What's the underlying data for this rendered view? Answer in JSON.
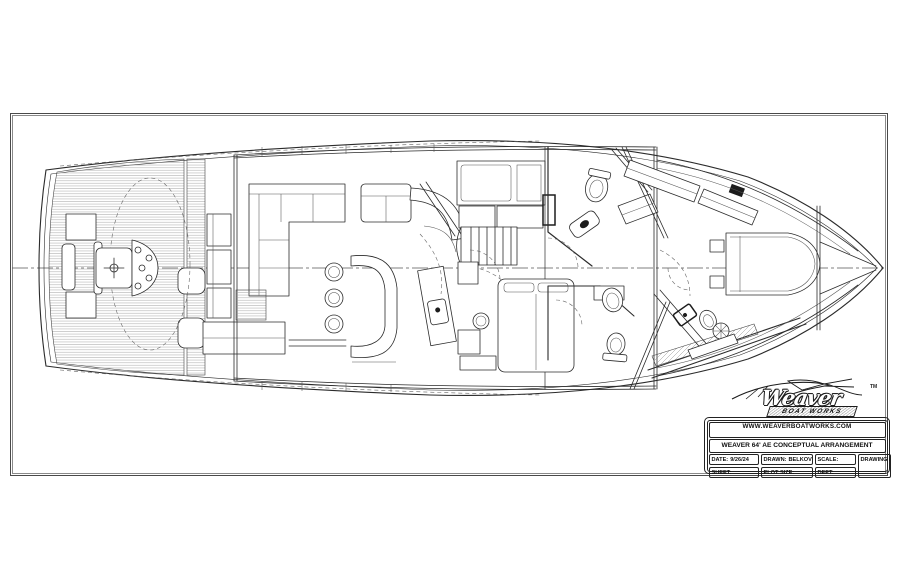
{
  "logo": {
    "brand": "Weaver",
    "sub": "BOAT WORKS",
    "tm": "TM"
  },
  "title_block": {
    "website": "WWW.WEAVERBOATWORKS.COM",
    "address": "390 DEALE ROAD   P.O. BOX 98   TRACYS LANDING, MD    410-867-0757  FAX 410-867-8755",
    "title": "WEAVER 64' AE CONCEPTUAL ARRANGEMENT",
    "fields": {
      "date_label": "DATE:",
      "date_value": "9/26/24",
      "drawn_label": "DRAWN:",
      "drawn_value": "BELKOV",
      "scale_label": "SCALE:",
      "scale_value": "",
      "sheet_label": "SHEET:",
      "sheet_value": "",
      "plot_label": "PLOT SIZE:",
      "plot_value": "",
      "dept_label": "DEPT:",
      "dept_value": "",
      "drawing_no_label": "DRAWING #"
    }
  },
  "colors": {
    "line": "#2b2b2b",
    "paper": "#ffffff",
    "hatch": "#999999"
  }
}
